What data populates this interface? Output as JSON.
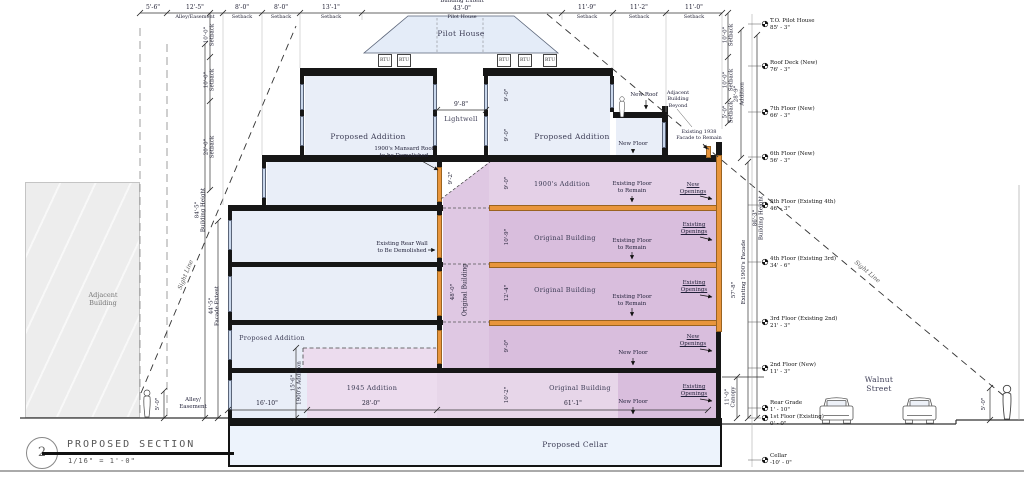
{
  "title_block": {
    "number": "2",
    "title": "PROPOSED SECTION",
    "scale": "1/16\" = 1'-0\""
  },
  "top_dims": {
    "extent_label": "Building Extent",
    "extent_value": "43'-0\"",
    "extent_sub": "Pilot House",
    "segments": [
      {
        "value": "5'-6\"",
        "label": ""
      },
      {
        "value": "12'-5\"",
        "label": "Alley/Easement"
      },
      {
        "value": "8'-0\"",
        "label": "Setback"
      },
      {
        "value": "8'-0\"",
        "label": "Setback"
      },
      {
        "value": "13'-1\"",
        "label": "Setback"
      },
      {
        "value": "11'-9\"",
        "label": "Setback"
      },
      {
        "value": "11'-2\"",
        "label": "Setback"
      },
      {
        "value": "11'-0\"",
        "label": "Setback"
      }
    ]
  },
  "left_dims": {
    "setback_upper": {
      "value": "10'-0\"",
      "label": "Setback"
    },
    "setback_mid": {
      "value": "10'-0\"",
      "label": "Setback"
    },
    "setback_lower": {
      "value": "20'-0\"",
      "label": "Setback"
    },
    "building_height": {
      "value": "84'-5\"",
      "label": "Building Height"
    },
    "facade_extent": {
      "value": "44'-5\"",
      "label": "Facade Extent"
    },
    "addition_1900": {
      "value": "15'-6\"",
      "label": "1900's Addition"
    },
    "alley_line1": "Alley/",
    "alley_line2": "Easement",
    "person_height": "5'-0\""
  },
  "right_dims": {
    "setback_upper": {
      "value": "10'-0\"",
      "label": "Setback"
    },
    "setback_mid": {
      "value": "10'-0\"",
      "label": "Setback"
    },
    "setback_lower": {
      "value": "5'-0\"",
      "label": "Setback"
    },
    "addition": {
      "value": "28'-9\"",
      "label": "Addition"
    },
    "building_height": {
      "value": "86'-3\"",
      "label": "Building Height"
    },
    "existing_facade": {
      "value": "57'-8\"",
      "label": "Existing 1900's Facade"
    },
    "canopy": {
      "value": "11'-0\"",
      "label": "Canopy"
    },
    "person_height": "5'-0\""
  },
  "levels": [
    {
      "name": "T.O. Pilot House",
      "elevation": "85' - 3\""
    },
    {
      "name": "Roof Deck (New)",
      "elevation": "76' - 3\""
    },
    {
      "name": "7th Floor (New)",
      "elevation": "66' - 3\""
    },
    {
      "name": "6th Floor (New)",
      "elevation": "56' - 3\""
    },
    {
      "name": "5th Floor (Existing 4th)",
      "elevation": "46' - 3\""
    },
    {
      "name": "4th Floor (Existing 3rd)",
      "elevation": "34' - 6\""
    },
    {
      "name": "3rd Floor (Existing 2nd)",
      "elevation": "21' - 3\""
    },
    {
      "name": "2nd Floor (New)",
      "elevation": "11' - 3\""
    },
    {
      "name": "Rear Grade",
      "elevation": "1' - 10\""
    },
    {
      "name": "1st Floor (Existing)",
      "elevation": "0' - 0\""
    },
    {
      "name": "Cellar",
      "elevation": "-10' - 0\""
    }
  ],
  "rooms": {
    "pilot_house": "Pilot House",
    "lightwell_dim": "9'-8\"",
    "lightwell": "Lightwell",
    "rtu": "RTU",
    "proposed_addition": "Proposed Addition",
    "addition_1900": "1900's Addition",
    "original_building": "Original Building",
    "addition_1945": "1945 Addition",
    "proposed_cellar": "Proposed Cellar",
    "adjacent_line1": "Adjacent",
    "adjacent_line2": "Building"
  },
  "annotations": {
    "mansard_1": "1900's Mansard Roof",
    "mansard_2": "to be Demolished",
    "rear_wall_1": "Existing Rear Wall",
    "rear_wall_2": "to Be Demolished",
    "floor_remain_1": "Existing Floor",
    "floor_remain_2": "to Remain",
    "new_word": "New",
    "existing_word": "Existing",
    "openings_word": "Openings",
    "new_floor": "New Floor",
    "new_roof": "New Roof",
    "adj_beyond_1": "Adjacent",
    "adj_beyond_2": "Building",
    "adj_beyond_3": "Beyond",
    "facade_1938_1": "Existing 1938",
    "facade_1938_2": "Facade to Remain",
    "sight_line": "Sight Line"
  },
  "interior_dims": {
    "core_height": "48'-0\"",
    "core_label": "Original Building",
    "mansard_height": "9'-2\"",
    "h9": "9'-0\"",
    "h10_9": "10'-9\"",
    "h12_4": "12'-4\"",
    "h10_2": "10'-2\"",
    "w16_10": "16'-10\"",
    "w28_0": "28'-0\"",
    "w61_1": "61'-1\""
  },
  "street": {
    "line1": "Walnut",
    "line2": "Street"
  }
}
